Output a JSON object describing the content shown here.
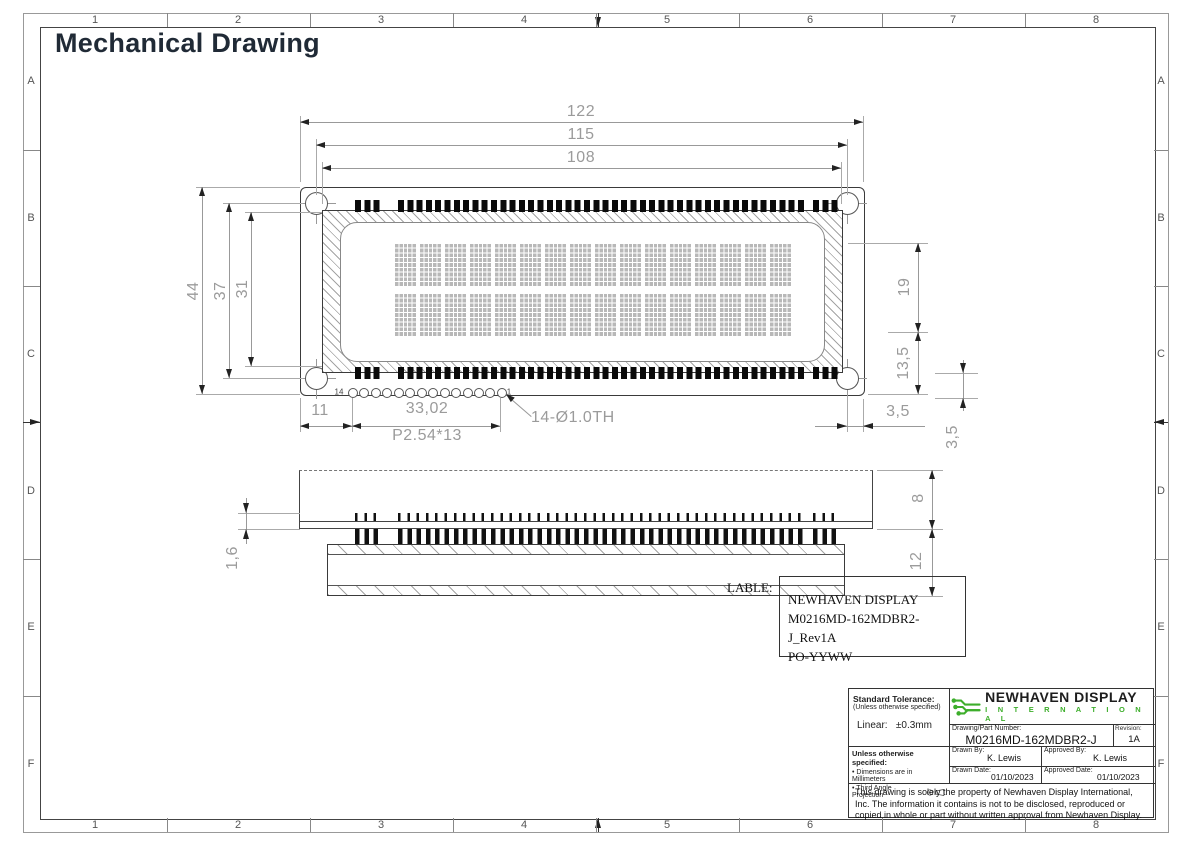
{
  "page": {
    "title": "Mechanical Drawing"
  },
  "sheet": {
    "columns": [
      "1",
      "2",
      "3",
      "4",
      "5",
      "6",
      "7",
      "8"
    ],
    "rows": [
      "A",
      "B",
      "C",
      "D",
      "E",
      "F"
    ]
  },
  "front_view": {
    "display": {
      "columns": 16,
      "rows": 2
    },
    "pin_count": 14,
    "dims": {
      "overall_width": "122",
      "hole_span_width": "115",
      "bezel_width": "108",
      "overall_height": "44",
      "hole_span_height": "37",
      "bezel_height": "31",
      "right_upper_height": "19",
      "right_lower_height": "13,5",
      "hole_edge_offset": "3,5",
      "pad_edge_offset": "3,5",
      "pin_offset": "11",
      "pin_span": "33,02",
      "pin_pitch": "P2.54*13",
      "pin_hole_note": "14-Ø1.0TH"
    },
    "pin_labels": {
      "last": "14",
      "first": "1"
    }
  },
  "side_view": {
    "dims": {
      "module_height": "8",
      "total_height": "12",
      "pcb_thickness": "1,6"
    }
  },
  "label": {
    "caption": "LABLE:",
    "lines": [
      "NEWHAVEN DISPLAY",
      "M0216MD-162MDBR2-J_Rev1A",
      "PO-YYWW"
    ]
  },
  "title_block": {
    "standard_tolerance_title": "Standard Tolerance:",
    "standard_tolerance_note": "(Unless otherwise specified)",
    "linear_tolerance": "Linear:   ±0.3mm",
    "logo": {
      "name": "NEWHAVEN DISPLAY",
      "subtitle": "I N T E R N A T I O N A L"
    },
    "part_number_label": "Drawing/Part Number:",
    "part_number": "M0216MD-162MDBR2-J",
    "revision_label": "Revision:",
    "revision": "1A",
    "drawn_by_label": "Drawn By:",
    "drawn_by": "K. Lewis",
    "approved_by_label": "Approved By:",
    "approved_by": "K. Lewis",
    "drawn_date_label": "Drawn Date:",
    "drawn_date": "01/10/2023",
    "approved_date_label": "Approved Date:",
    "approved_date": "01/10/2023",
    "unless_specified_title": "Unless otherwise specified:",
    "unless_specified_items": [
      "• Dimensions are in Millimeters",
      "• Third Angle Projection"
    ],
    "disclaimer": "This drawing is solely the property of Newhaven Display International, Inc. The information it contains is not to be disclosed, reproduced or copied in whole or part without written approval from Newhaven Display."
  },
  "colors": {
    "logo_green": "#3DAE2B",
    "ink": "#222222",
    "dim_text": "#9b9b9b"
  }
}
